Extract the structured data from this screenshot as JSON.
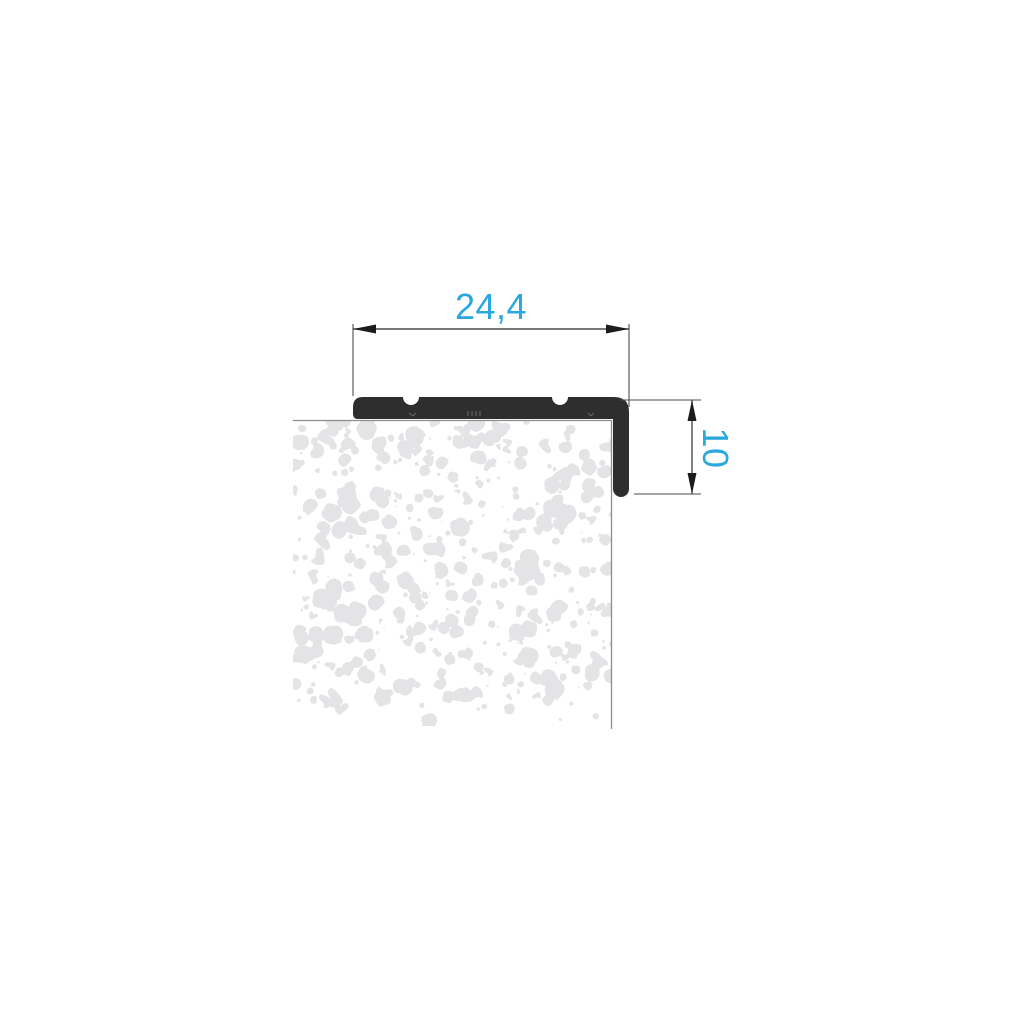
{
  "drawing": {
    "type": "profile-cross-section",
    "dimensions": {
      "width": {
        "label": "24,4",
        "orientation": "horizontal"
      },
      "height": {
        "label": "10",
        "orientation": "vertical"
      }
    },
    "colors": {
      "dimension_text": "#2aa8df",
      "profile": "#2e2e2e",
      "dimension_line": "#4d4d4d",
      "surface_line": "#8d8d8d",
      "speckle": "#e4e4e7",
      "background": "#ffffff"
    }
  }
}
